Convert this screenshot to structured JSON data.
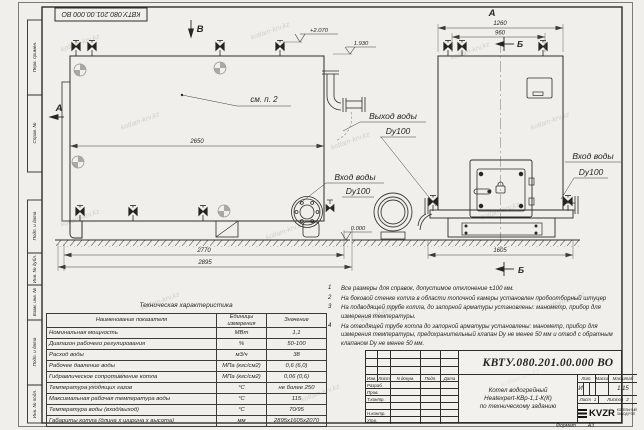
{
  "sheet": {
    "watermark": "kotlam-krv.kz",
    "paper_color": "#f0efeb",
    "line_color": "#2e2e28"
  },
  "top_stamp": "КВТУ.080.201.00.000  ВО",
  "margin": {
    "top_fields": [
      "Перв. примен.",
      "Справ. №"
    ],
    "bottom_fields": [
      "Подп. и дата",
      "Инв. № дубл.",
      "Взам. инв. №",
      "Подп. и дата",
      "Инв. № подл."
    ]
  },
  "drawing": {
    "section_v": "В",
    "view_a_side": "А",
    "view_a_top": "А",
    "section_b_top": "Б",
    "section_b_bottom": "Б",
    "see_note": "см. п. 2",
    "elev_top": "+2.070",
    "elev_pipe": "1.930",
    "elev_zero": "0.000",
    "dim_2650": "2650",
    "dim_2770": "2770",
    "dim_2895": "2895",
    "dim_1260": "1260",
    "dim_960": "960",
    "dim_1605": "1605",
    "outlet_line1": "Выход воды",
    "outlet_line2": "Dy100",
    "inlet_left_line1": "Вход воды",
    "inlet_left_line2": "Dy100",
    "inlet_right_line1": "Вход воды",
    "inlet_right_line2": "Dy100"
  },
  "notes": {
    "items": [
      {
        "n": "1",
        "text": "Все размеры для справок, допустимое отклонение ±100 мм."
      },
      {
        "n": "2",
        "text": "На боковой стенке котла в области топочной камеры установлен пробоотборный штуцер"
      },
      {
        "n": "3",
        "text": "На  подводящей трубе котла, до запорной арматуры установлены: манометр, прибор для измерения температуры."
      },
      {
        "n": "4",
        "text": "На отводящей трубе котла до запорной арматуры установлены: манометр, прибор для измерения температуры, предохранительный клапан Dу не менее 50 мм и отвод с обратным клапаном Dу не менее 50 мм."
      }
    ]
  },
  "tech_table": {
    "title": "Техническая характеристика",
    "headers": [
      "Наименование показателя",
      "Единицы измерения",
      "Значение"
    ],
    "rows": [
      [
        "Номинальная мощность",
        "МВт",
        "1,1"
      ],
      [
        "Диапазон рабочего регулирования",
        "%",
        "50-100"
      ],
      [
        "Расход воды",
        "м3/ч",
        "38"
      ],
      [
        "Рабочее давление воды",
        "МПа (кгс/см2)",
        "0,6 (6,0)"
      ],
      [
        "Гидравлическое сопротивление котла",
        "МПа (кгс/см2)",
        "0,06 (0,6)"
      ],
      [
        "Температура уходящих газов",
        "°С",
        "не более 250"
      ],
      [
        "Максимальная рабочая температура воды",
        "°С",
        "115"
      ],
      [
        "Температура воды (вход/выход)",
        "°С",
        "70/95"
      ],
      [
        "Габариты котла (длина х ширина х высота)",
        "мм",
        "2895х1605х2070"
      ]
    ]
  },
  "title_block": {
    "designation": "КВТУ.080.201.00.000  ВО",
    "rev_headers": [
      "Изм.",
      "Лист",
      "N докум.",
      "Подп.",
      "Дата"
    ],
    "sig_rows": [
      "Разраб.",
      "Пров.",
      "Т.контр.",
      "",
      "Н.контр.",
      "Утв."
    ],
    "product_lines": [
      "Котел водогрейный",
      "Heatexpert-КВр-1,1-К(К)",
      "по техническому заданию"
    ],
    "lit_header": "Лит.",
    "mass_header": "Масса",
    "scale_header": "Масштаб",
    "lit_value": "И",
    "scale_value": "1:15",
    "sheet_label": "Лист",
    "sheet_value": "1",
    "sheets_label": "Листов",
    "sheets_value": "2",
    "logo_text": "KVZR",
    "org_line1": "КОТЕЛЬНЫЙ",
    "org_line2": "ЗАВОД РЭП",
    "format_label": "Формат",
    "format_value": "А3"
  }
}
